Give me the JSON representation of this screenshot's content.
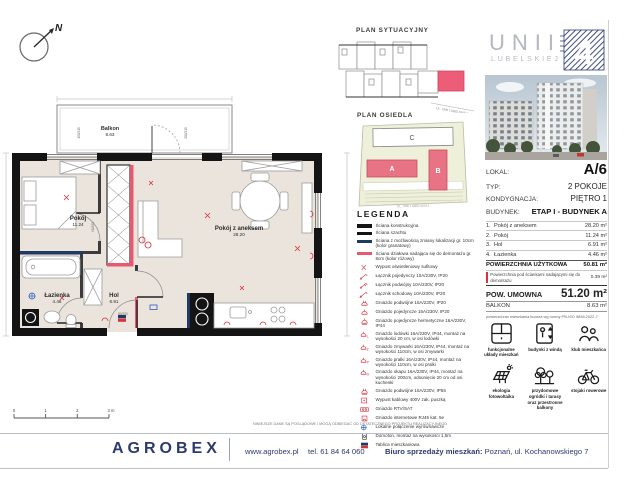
{
  "page": {
    "compass": "N",
    "disclaimer": "NINIEJSZE DANE SĄ POGLĄDOWE I MOGĄ ODBIEGAĆ OD OSTATECZNEGO PROJEKTU REALIZACYJNEGO"
  },
  "floorplan": {
    "rooms": {
      "balkon": {
        "name": "Balkon",
        "area": "8.63"
      },
      "pokoj": {
        "name": "Pokój",
        "area": "11.24"
      },
      "aneks": {
        "name": "Pokój z aneksem",
        "area": "28.20"
      },
      "lazienka": {
        "name": "Łazienka",
        "area": "4.46"
      },
      "hol": {
        "name": "Hol",
        "area": "6.91"
      }
    },
    "dims": [
      "150/215",
      "300/215",
      "90/200",
      "80/200"
    ],
    "scale_ticks": [
      "0",
      "1",
      "2",
      "3 m"
    ]
  },
  "maps": {
    "situational_title": "PLAN SYTUACYJNY",
    "estate_title": "PLAN OSIEDLA",
    "street": "UL. UNII LUBELSKIEJ",
    "buildings": {
      "a": "A",
      "b": "B",
      "c": "C"
    }
  },
  "brand": {
    "logo_top": "UNII",
    "logo_bottom": "LUBELSKIEJ",
    "logo_number": "4"
  },
  "details": {
    "lokal_label": "LOKAL:",
    "lokal_value": "A/6",
    "typ_label": "TYP:",
    "typ_value": "2 POKOJE",
    "kondygnacja_label": "KONDYGNACJA:",
    "kondygnacja_value": "PIĘTRO 1",
    "budynek_label": "BUDYNEK:",
    "budynek_value": "ETAP I - BUDYNEK A",
    "rooms": [
      {
        "no": "1.",
        "name": "Pokój z aneksem",
        "area": "28.20 m²"
      },
      {
        "no": "2.",
        "name": "Pokój",
        "area": "11.24 m²"
      },
      {
        "no": "3.",
        "name": "Hol",
        "area": "6.91 m²"
      },
      {
        "no": "4.",
        "name": "Łazienka",
        "area": "4.46 m²"
      }
    ],
    "usable_label": "POWIERZCHNIA UŻYTKOWA",
    "usable_value": "50.81 m²",
    "note_text": "Powierzchnia pod ściankami nadającymi się do demontażu",
    "note_value": "0.39 m²",
    "contract_label": "POW. UMOWNA",
    "contract_value": "51.20 m²",
    "balkon_label": "BALKON",
    "balkon_value": "8.63 m²",
    "footnote": "powierzchnia mieszkania liczona wg normy PN-ISO 9836:2022-7"
  },
  "legend": {
    "title": "LEGENDA",
    "items": [
      {
        "icon": "wall-solid-swatch",
        "label": "Ściana konstrukcyjna"
      },
      {
        "icon": "wall-shaft-swatch",
        "label": "Ściana szachtu"
      },
      {
        "icon": "wall-navy-swatch",
        "label": "Ściana z możliwością zmiany lokalizacji gr. 10cm (kolor granatowy)"
      },
      {
        "icon": "wall-pink-swatch",
        "label": "Ściana działowa nadająca się do demontażu gr. 8cm (kolor różowy)"
      },
      {
        "icon": "ceiling-light-icon",
        "label": "Wypust oświetleniowy sufitowy"
      },
      {
        "icon": "switch-single-icon",
        "label": "Łącznik pojedynczy 10A/230V, IP20"
      },
      {
        "icon": "switch-double-icon",
        "label": "Łącznik podwójny 10A/230V, IP20"
      },
      {
        "icon": "switch-stair-icon",
        "label": "Łącznik schodowy 10A/230V, IP20"
      },
      {
        "icon": "socket-double-icon",
        "label": "Gniazdo podwójne 16A/230V, IP20"
      },
      {
        "icon": "socket-single-icon",
        "label": "Gniazdo pojedyncze 16A/230V, IP20"
      },
      {
        "icon": "socket-hermetic-icon",
        "label": "Gniazdo pojedyncze hermetyczne 16A/230V, IP44"
      },
      {
        "icon": "socket-fridge-icon",
        "label": "Gniazdo lodówki 16A/230V, IP44, montaż na wysokości 20 cm, w osi lodówki"
      },
      {
        "icon": "socket-dishwasher-icon",
        "label": "Gniazdo zmywarki 16A/230V, IP44, montaż na wysokości 110cm, w osi zmywarki"
      },
      {
        "icon": "socket-washer-icon",
        "label": "Gniazdo pralki 16A/230V, IP44, montaż na wysokości 110cm, w osi pralki"
      },
      {
        "icon": "socket-hood-icon",
        "label": "Gniazdo okapu 16A/230V, IP44, montaż na wysokości 200cm, odsunięcie 20 cm od osi kuchenki"
      },
      {
        "icon": "socket-ip55-icon",
        "label": "Gniazdo podwójne 16A/230V, IP55"
      },
      {
        "icon": "cable-outlet-icon",
        "label": "Wypust kablowy 400V zak. puszką"
      },
      {
        "icon": "socket-rtv-icon",
        "label": "Gniazdo RTV/SAT"
      },
      {
        "icon": "socket-rj45-icon",
        "label": "Gniazdo internetowe RJ45 kat. 5e"
      },
      {
        "icon": "equipotential-icon",
        "label": "Lokalne połączenie wyrównawcze"
      },
      {
        "icon": "intercom-icon",
        "label": "Domofon, montaż na wysokości 1,5m"
      },
      {
        "icon": "meter-board-icon",
        "label": "Tablica mieszkaniowa"
      }
    ]
  },
  "amenities": {
    "items": [
      {
        "icon": "floorplan-icon",
        "label": "funkcjonalne układy mieszkań"
      },
      {
        "icon": "elevator-icon",
        "label": "budynki z windą"
      },
      {
        "icon": "residents-club-icon",
        "label": "klub mieszkańca"
      },
      {
        "icon": "photovoltaics-icon",
        "label": "ekologia fotowoltaika"
      },
      {
        "icon": "gardens-icon",
        "label": "przydomowe ogródki i tarasy oraz przestronne balkony"
      },
      {
        "icon": "bike-rack-icon",
        "label": "stojaki rowerowe"
      }
    ]
  },
  "footer": {
    "brand": "AGROBEX",
    "website": "www.agrobex.pl",
    "phone": "tel. 61 84 64 060",
    "office_label": "Biuro sprzedaży mieszkań:",
    "office_value": "Poznań, ul. Kochanowskiego 7"
  }
}
